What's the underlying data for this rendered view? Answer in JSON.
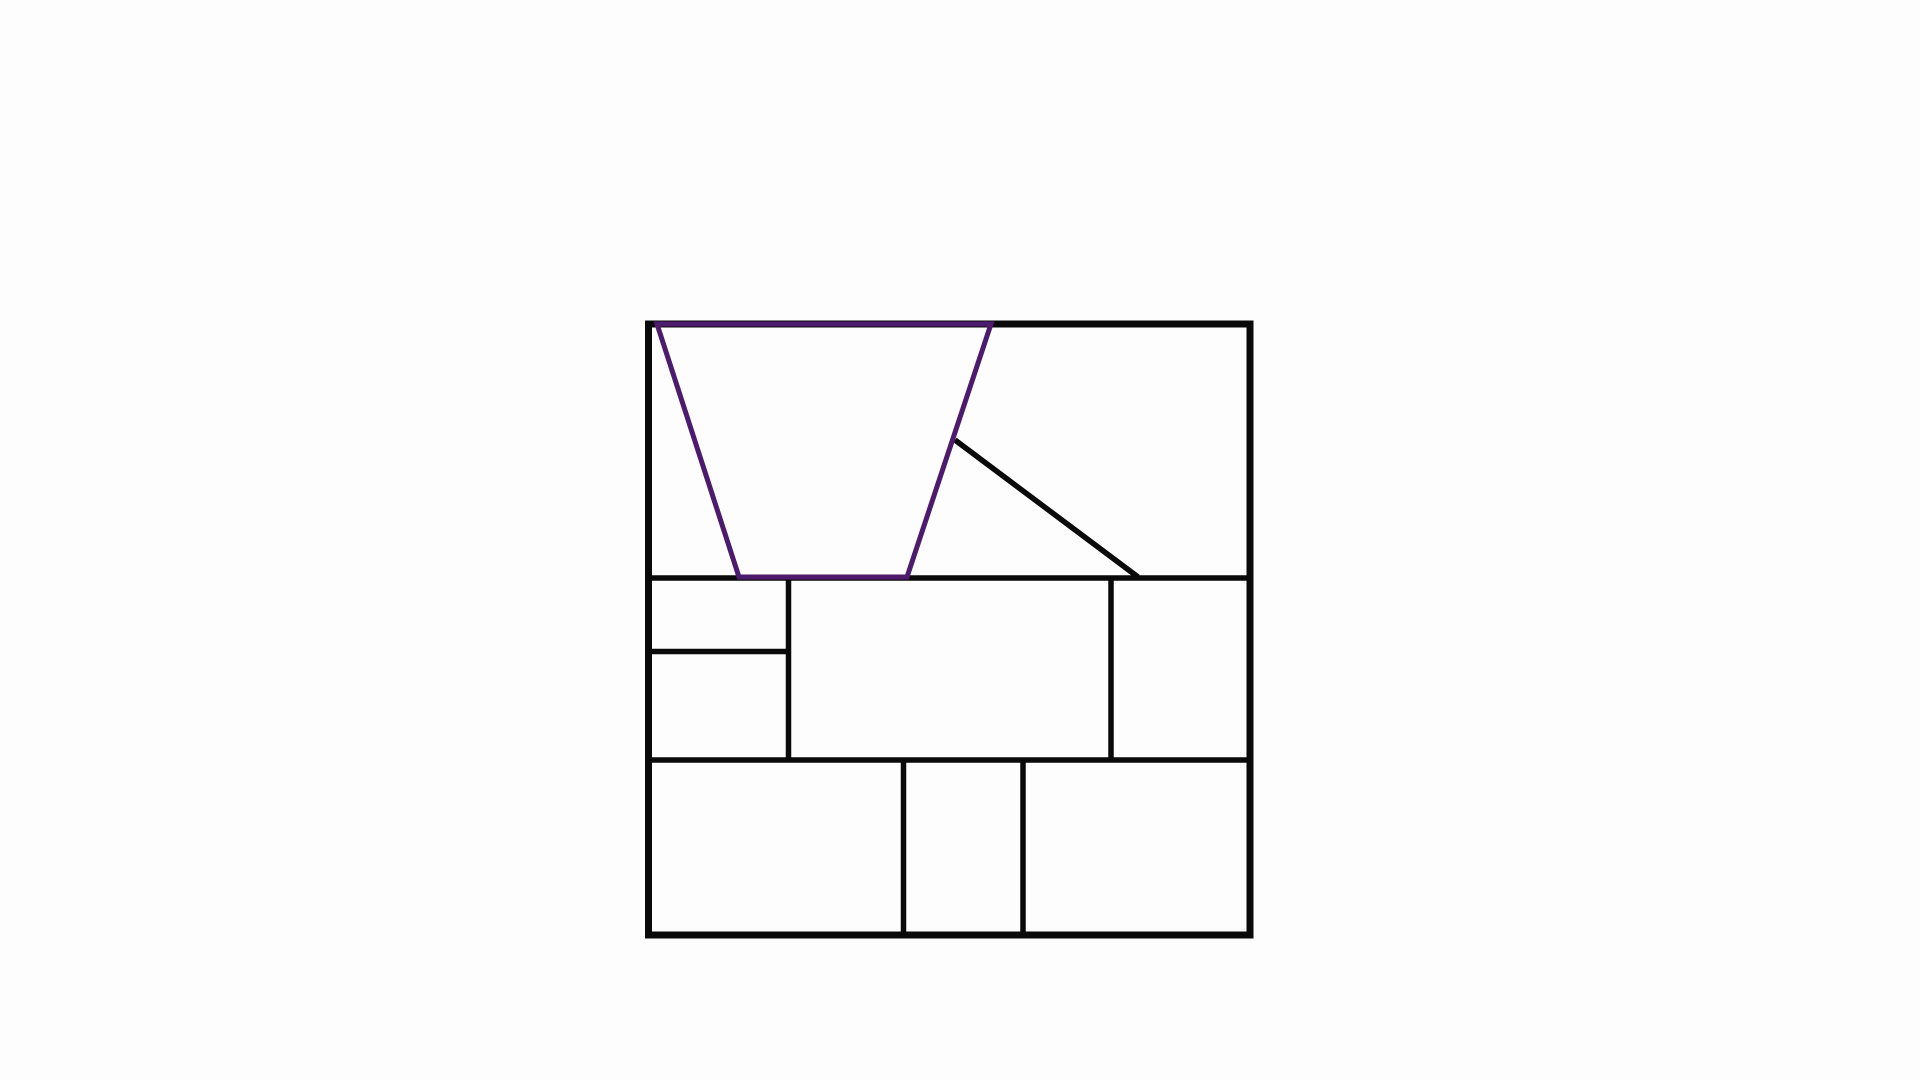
{
  "canvas": {
    "width": 1920,
    "height": 1080,
    "background_color": "#fdfdfd"
  },
  "figure": {
    "description": "square-partitioned-into-rectangles-with-highlighted-trapezoid",
    "colors": {
      "line_black": "#0a0a0a",
      "highlight_purple": "#4d1b6d"
    },
    "outer_square": {
      "name": "outer-square",
      "x": 648.5,
      "y": 324,
      "width": 601.5,
      "height": 611,
      "stroke_width": 7
    },
    "segments": [
      {
        "name": "divider-middle-band-top",
        "x1": 645,
        "y1": 578,
        "x2": 1252,
        "y2": 578,
        "stroke_width": 5.5
      },
      {
        "name": "divider-bottom-band-top",
        "x1": 645,
        "y1": 760,
        "x2": 1252,
        "y2": 760,
        "stroke_width": 5.5
      },
      {
        "name": "divider-left-column-split",
        "x1": 645,
        "y1": 651.5,
        "x2": 789,
        "y2": 651.5,
        "stroke_width": 5.5
      },
      {
        "name": "divider-left-column-right",
        "x1": 788.5,
        "y1": 577,
        "x2": 788.5,
        "y2": 760,
        "stroke_width": 5.5
      },
      {
        "name": "divider-center-right",
        "x1": 1111,
        "y1": 577,
        "x2": 1111,
        "y2": 760,
        "stroke_width": 5.5
      },
      {
        "name": "divider-bottom-band-left",
        "x1": 903.5,
        "y1": 759,
        "x2": 903.5,
        "y2": 936,
        "stroke_width": 5.5
      },
      {
        "name": "divider-bottom-band-right",
        "x1": 1023,
        "y1": 759,
        "x2": 1023,
        "y2": 936,
        "stroke_width": 5.5
      },
      {
        "name": "diagonal-line",
        "x1": 955,
        "y1": 440,
        "x2": 1138,
        "y2": 577,
        "stroke_width": 5.5
      }
    ],
    "trapezoid": {
      "name": "highlighted-trapezoid",
      "points": "657,324 991,324 907,577 739,577",
      "stroke_width": 5
    }
  }
}
